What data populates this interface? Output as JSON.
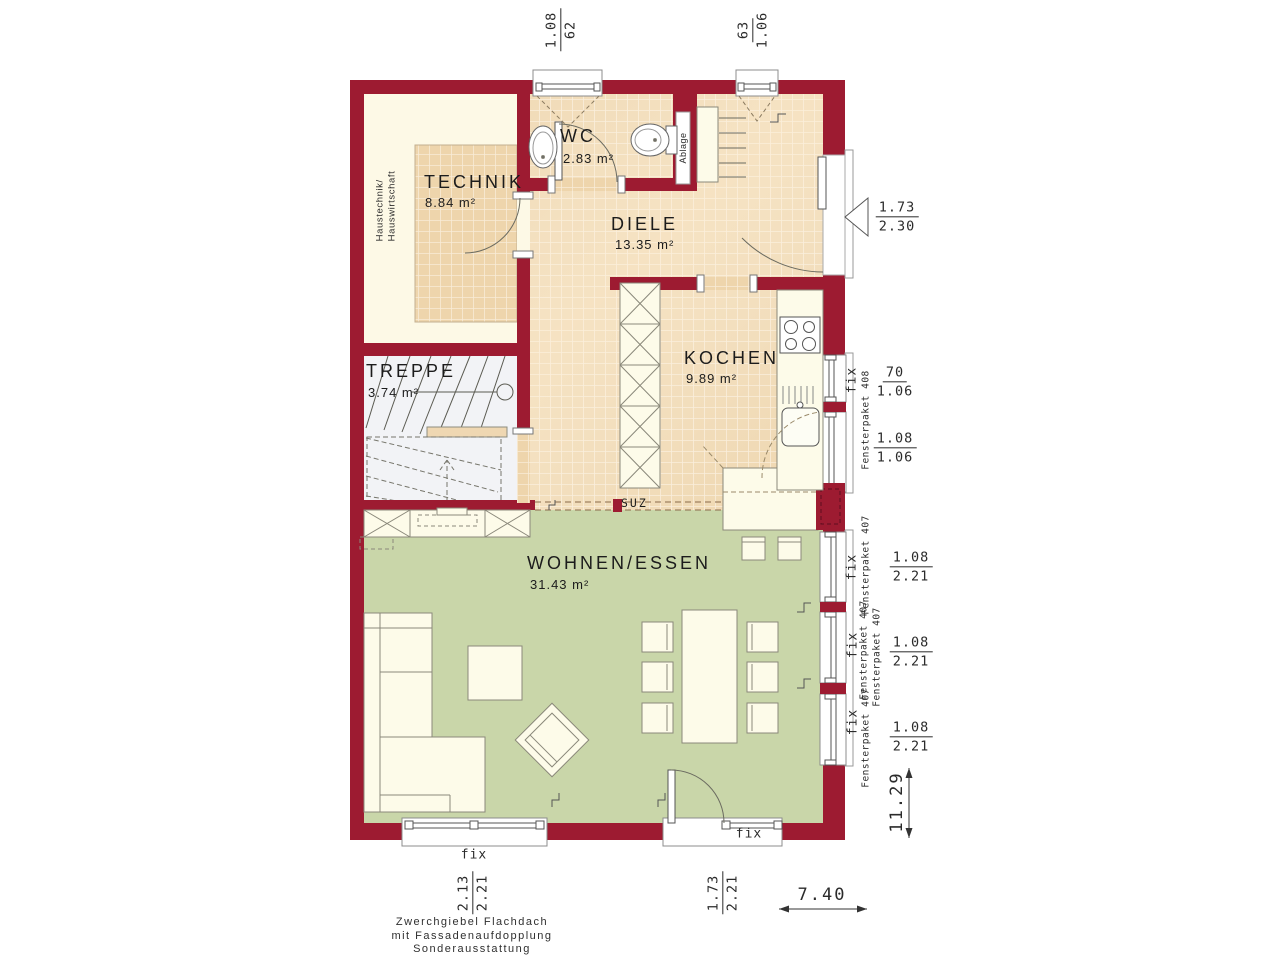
{
  "colors": {
    "wall": "#9d1b31",
    "tile_floor": "#eed5ac",
    "tile_grout": "#f9ecd7",
    "living_floor": "#c9d6a9",
    "technik_floor": "#fdf9e6",
    "furniture_fill": "#fdfbe9",
    "line": "#555555"
  },
  "rooms": {
    "technik": {
      "name": "TECHNIK",
      "area": "8.84 m²"
    },
    "wc": {
      "name": "WC",
      "area": "2.83 m²"
    },
    "diele": {
      "name": "DIELE",
      "area": "13.35 m²"
    },
    "kochen": {
      "name": "KOCHEN",
      "area": "9.89 m²"
    },
    "treppe": {
      "name": "TREPPE",
      "area": "3.74 m²"
    },
    "wohnen_essen": {
      "name": "WOHNEN/ESSEN",
      "area": "31.43 m²"
    }
  },
  "annotations": {
    "haustechnik_line1": "Haustechnik/",
    "haustechnik_line2": "Hauswirtschaft",
    "ablage": "Ablage",
    "suz": "SUZ",
    "fix": "fix",
    "fensterpaket_408": "Fensterpaket 408",
    "fensterpaket_407": "Fensterpaket 407"
  },
  "dimensions": {
    "top_left_window": {
      "num": "1.08",
      "den": "62"
    },
    "top_right_window": {
      "num": "63",
      "den": "1.06"
    },
    "entrance_door": {
      "num": "1.73",
      "den": "2.30"
    },
    "kitchen_window_small": {
      "num": "70",
      "den": "1.06"
    },
    "kitchen_window_large": {
      "num": "1.08",
      "den": "1.06"
    },
    "living_window_1": {
      "num": "1.08",
      "den": "2.21"
    },
    "living_window_2": {
      "num": "1.08",
      "den": "2.21"
    },
    "living_window_3": {
      "num": "1.08",
      "den": "2.21"
    },
    "terrace_window": {
      "num": "2.13",
      "den": "2.21"
    },
    "terrace_door": {
      "num": "1.73",
      "den": "2.21"
    },
    "overall_width": "7.40",
    "overall_depth": "11.29"
  },
  "footer": {
    "line1": "Zwerchgiebel Flachdach",
    "line2": "mit Fassadenaufdopplung",
    "line3": "Sonderausstattung"
  }
}
